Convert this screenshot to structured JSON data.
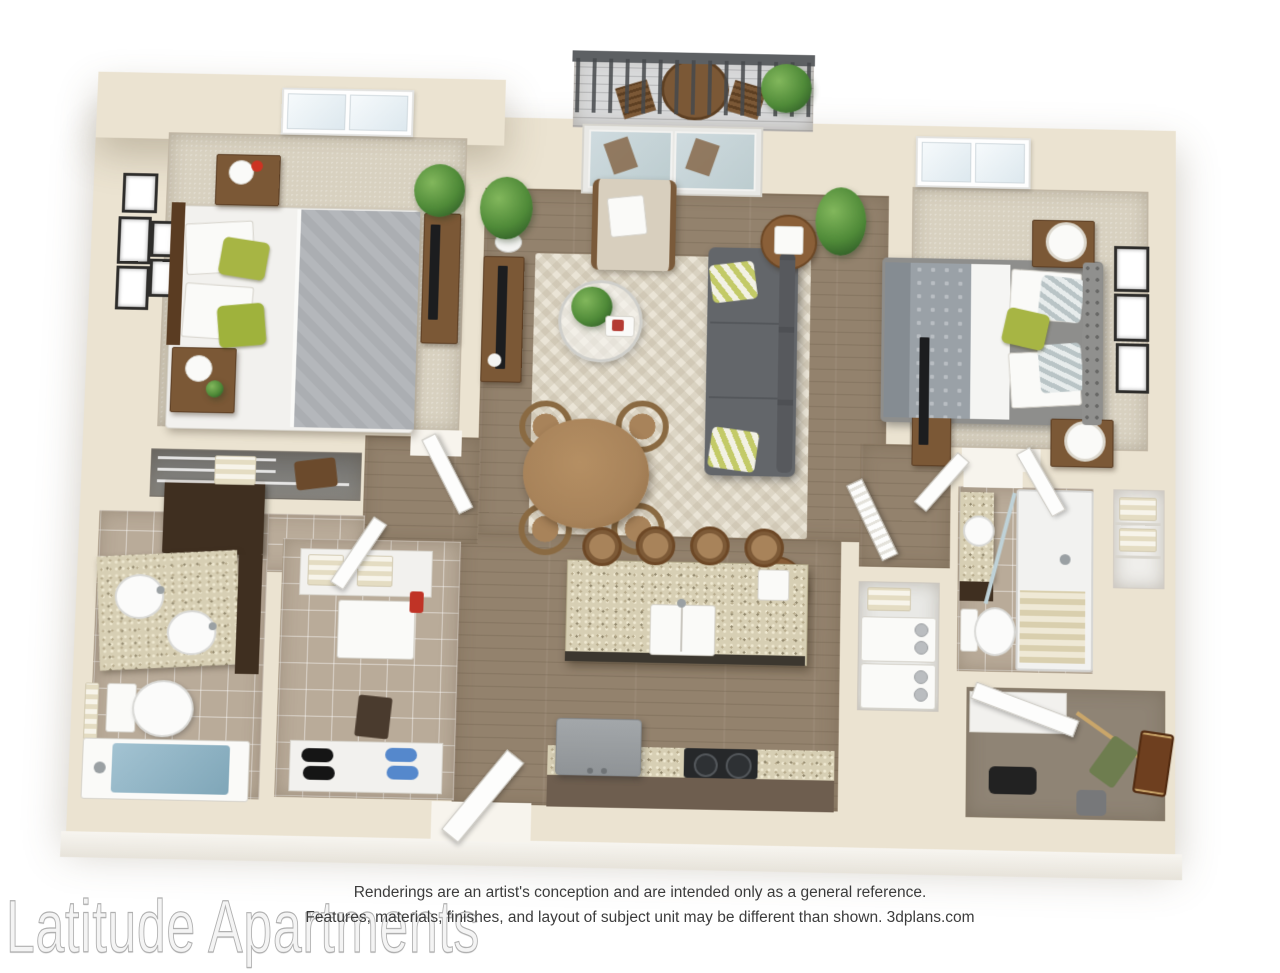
{
  "page": {
    "width": 1280,
    "height": 960,
    "background": "#ffffff"
  },
  "watermark": {
    "text": "Latitude Apartments",
    "color": "#c9c9c9"
  },
  "disclaimer": {
    "line1": "Renderings are an artist's conception and are intended only as a general reference.",
    "line2": "Features, materials, finishes, and layout of subject unit may be different than shown. 3dplans.com",
    "source": "3dplans.com",
    "color": "#3c3c3c"
  },
  "floor_plan": {
    "type": "3d-apartment-floor-plan",
    "unit_description": "2 bedroom / 2 bathroom apartment with balcony, open kitchen island and walk-in closets",
    "palette": {
      "wall": "#ebe3d1",
      "hardwood": "#93826d",
      "carpet": "#d8d1c0",
      "tile": "#b9ab99",
      "granite": "#d7cfb4",
      "sofa_gray": "#63666a",
      "accent_green": "#a7b544",
      "wood_furniture": "#7b5836",
      "tub_water": "#8fb5c6",
      "deck": "#d8d9da"
    },
    "rooms": [
      {
        "name": "bedroom-1",
        "floor": "carpet",
        "items": [
          "skylight-window",
          "queen-bed-white-gray-bedding",
          "green-accent-pillows",
          "nightstand-with-vase-red-flowers",
          "nightstand-with-lamp-plant",
          "gallery-wall-5-frames",
          "tv-dresser",
          "potted-plant"
        ]
      },
      {
        "name": "living-dining",
        "floor": "hardwood",
        "items": [
          "balcony-sliding-glass-doors",
          "beige-armchair",
          "gray-sofa",
          "yellow-green-accent-pillows",
          "round-glass-coffee-table-with-plant",
          "chevron-area-rug",
          "round-dining-table",
          "bentwood-dining-chairs-x4",
          "tv-console",
          "side-table-with-lamp",
          "side-table-with-lamp-2",
          "potted-plants-x2"
        ]
      },
      {
        "name": "balcony",
        "floor": "deck",
        "items": [
          "metal-railing",
          "bistro-table",
          "folding-chairs-x2",
          "potted-plant"
        ]
      },
      {
        "name": "bedroom-2",
        "floor": "carpet",
        "items": [
          "skylight-window",
          "queen-bed-gray-patterned-bedding",
          "tufted-headboard",
          "green-accent-pillow",
          "nightstand-with-drum-lamp-x2",
          "wall-frames-x3",
          "tv-dresser"
        ]
      },
      {
        "name": "bathroom-1",
        "floor": "tile",
        "items": [
          "double-sink-granite-vanity",
          "dark-wood-cabinets",
          "toilet-with-towel-bar",
          "bathtub-with-water"
        ]
      },
      {
        "name": "bedroom-1-closet",
        "floor": "none",
        "items": [
          "wire-shelving",
          "towel-stack",
          "bag"
        ]
      },
      {
        "name": "storage-closet",
        "floor": "tile",
        "items": [
          "shelf-with-towels",
          "small-white-appliance",
          "red-bottle",
          "hamper",
          "shoe-shelf-black-shoes",
          "shoe-shelf-blue-shoes"
        ]
      },
      {
        "name": "kitchen",
        "floor": "hardwood",
        "items": [
          "granite-island-with-double-sink",
          "bar-stools-x4",
          "refrigerator",
          "black-cooktop-range",
          "granite-counter-run"
        ]
      },
      {
        "name": "laundry-closet",
        "floor": "none",
        "items": [
          "towel-shelf",
          "stacked-washer-dryer"
        ]
      },
      {
        "name": "bathroom-2",
        "floor": "tile",
        "items": [
          "granite-vanity-round-sink",
          "toilet",
          "walk-in-shower-glass-door",
          "striped-shower-curtain",
          "shower-head"
        ]
      },
      {
        "name": "linen-closet",
        "floor": "none",
        "items": [
          "shelves",
          "striped-towels-x2"
        ]
      },
      {
        "name": "walk-in-closet",
        "floor": "dark-carpet",
        "items": [
          "white-shelf",
          "hanging-rod-with-clothes",
          "green-garment",
          "brown-suitcase",
          "gray-bag",
          "black-clothes-pile"
        ]
      },
      {
        "name": "entry",
        "floor": "hardwood",
        "items": [
          "open-front-door"
        ]
      }
    ]
  }
}
